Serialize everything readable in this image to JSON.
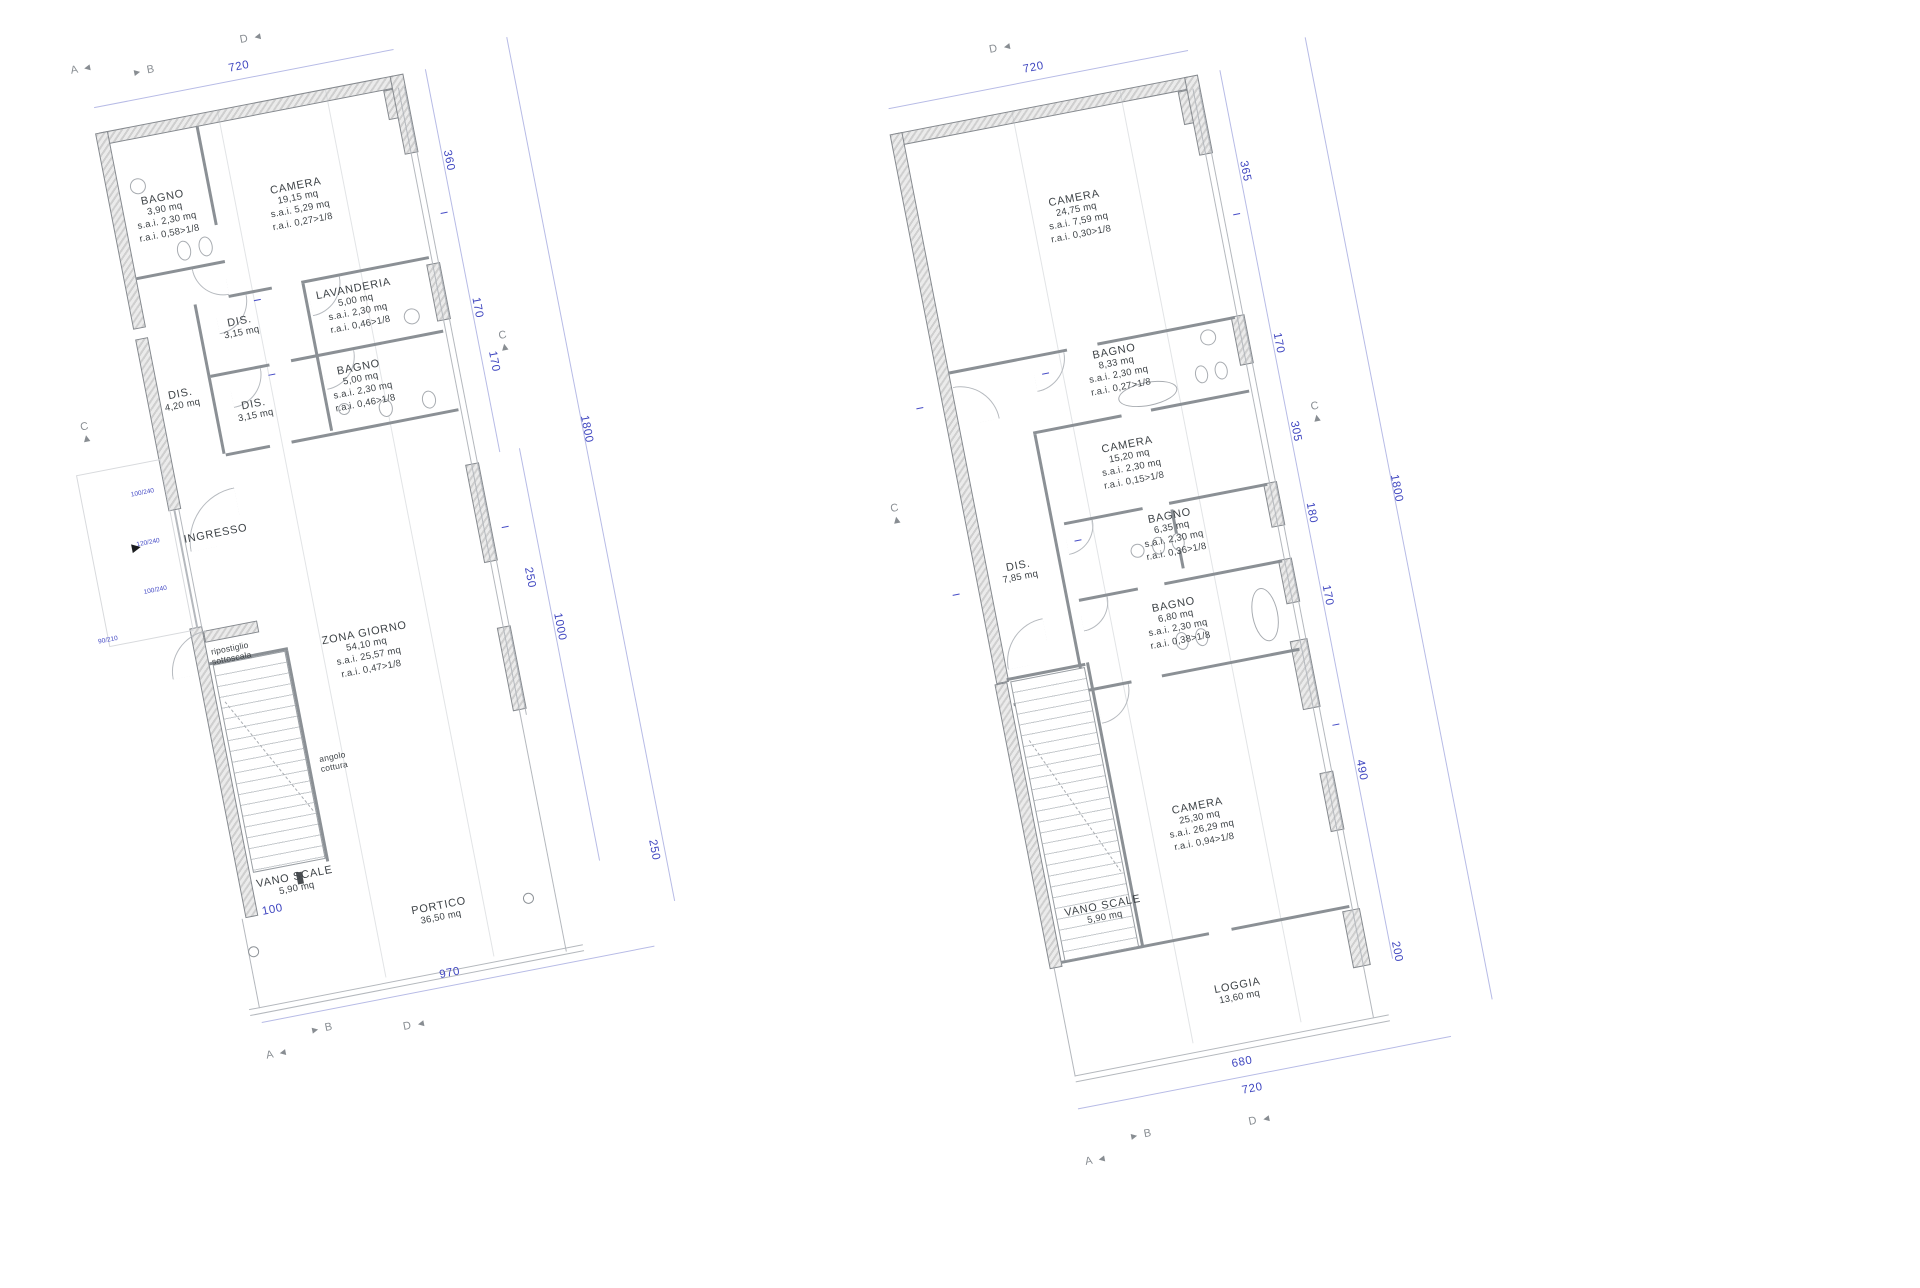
{
  "palette": {
    "dim_blue": "#3f46c0",
    "wall_outline": "#85898e",
    "wall_fill": "#d9d9d9",
    "line_gray": "#9aa0a6",
    "label_color": "#3e4347"
  },
  "icons": {
    "entrance": "►",
    "arrow_left": "◄",
    "arrow_right": "►",
    "arrow_up": "▲"
  },
  "markers": {
    "a": "A",
    "b": "B",
    "c": "C",
    "d": "D"
  },
  "plans": [
    {
      "rooms": [
        {
          "label": "BAGNO",
          "lines": [
            "3,90 mq",
            "s.a.i. 2,30 mq",
            "r.a.i. 0,58>1/8"
          ]
        },
        {
          "label": "CAMERA",
          "lines": [
            "19,15 mq",
            "s.a.i. 5,29 mq",
            "r.a.i. 0,27>1/8"
          ]
        },
        {
          "label": "LAVANDERIA",
          "lines": [
            "5,00 mq",
            "s.a.i. 2,30 mq",
            "r.a.i. 0,46>1/8"
          ]
        },
        {
          "label": "DIS.",
          "lines": [
            "3,15 mq"
          ]
        },
        {
          "label": "DIS.",
          "lines": [
            "4,20 mq"
          ]
        },
        {
          "label": "BAGNO",
          "lines": [
            "5,00 mq",
            "s.a.i. 2,30 mq",
            "r.a.i. 0,46>1/8"
          ]
        },
        {
          "label": "DIS.",
          "lines": [
            "3,15 mq"
          ]
        },
        {
          "label": "INGRESSO",
          "lines": []
        },
        {
          "label": "ripostiglio",
          "lines": [
            "sottoscala"
          ]
        },
        {
          "label": "ZONA GIORNO",
          "lines": [
            "54,10 mq",
            "s.a.i. 25,57 mq",
            "r.a.i. 0,47>1/8"
          ]
        },
        {
          "label": "angolo",
          "lines": [
            "cottura"
          ]
        },
        {
          "label": "VANO SCALE",
          "lines": [
            "5,90 mq"
          ]
        },
        {
          "label": "PORTICO",
          "lines": [
            "36,50 mq"
          ]
        }
      ],
      "dims": {
        "top": "720",
        "right": [
          "360",
          "170",
          "170"
        ],
        "mid": [
          "250",
          "1000"
        ],
        "overall": "1800",
        "portico": "250",
        "bottom": [
          "100",
          "970"
        ]
      },
      "tags": [
        "100/240",
        "120/240",
        "100/240",
        "90/210"
      ]
    },
    {
      "rooms": [
        {
          "label": "CAMERA",
          "lines": [
            "24,75 mq",
            "s.a.i. 7,59 mq",
            "r.a.i. 0,30>1/8"
          ]
        },
        {
          "label": "BAGNO",
          "lines": [
            "8,33 mq",
            "s.a.i. 2,30 mq",
            "r.a.i. 0,27>1/8"
          ]
        },
        {
          "label": "CAMERA",
          "lines": [
            "15,20 mq",
            "s.a.i. 2,30 mq",
            "r.a.i. 0,15>1/8"
          ]
        },
        {
          "label": "BAGNO",
          "lines": [
            "6,35 mq",
            "s.a.i. 2,30 mq",
            "r.a.i. 0,36>1/8"
          ]
        },
        {
          "label": "DIS.",
          "lines": [
            "7,85 mq"
          ]
        },
        {
          "label": "BAGNO",
          "lines": [
            "6,80 mq",
            "s.a.i. 2,30 mq",
            "r.a.i. 0,38>1/8"
          ]
        },
        {
          "label": "CAMERA",
          "lines": [
            "25,30 mq",
            "s.a.i. 26,29 mq",
            "r.a.i. 0,94>1/8"
          ]
        },
        {
          "label": "VANO SCALE",
          "lines": [
            "5,90 mq"
          ]
        },
        {
          "label": "LOGGIA",
          "lines": [
            "13,60 mq"
          ]
        }
      ],
      "dims": {
        "top": "720",
        "right": [
          "365",
          "170",
          "305",
          "180",
          "170",
          "490",
          "200"
        ],
        "overall": "1800",
        "bottom": [
          "680",
          "720"
        ]
      }
    }
  ]
}
